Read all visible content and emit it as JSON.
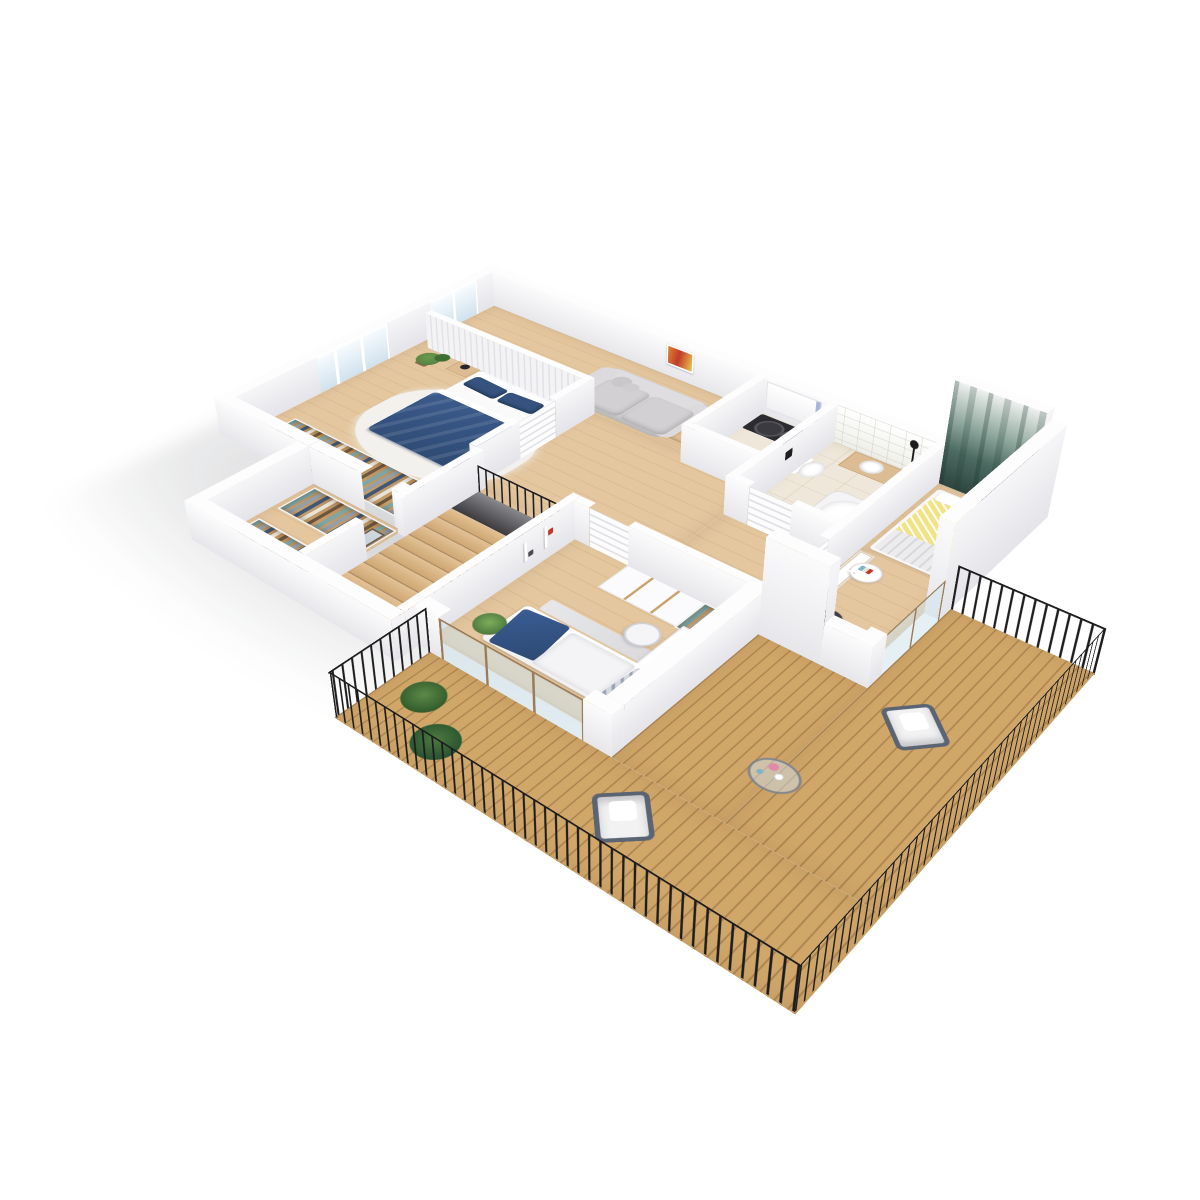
{
  "scene": {
    "type": "isometric 3D floor plan rendering",
    "description": "Photoreal axonometric cutaway of an apartment upper floor with balcony, white walls, oak floors, no text labels",
    "background": "#ffffff",
    "view": "isometric from above, rotated ~40 degrees"
  },
  "palette": {
    "wood": "#e4c79f",
    "deck": "#d0a669",
    "tile": "#efe8da",
    "wall_top": "#fdfdfe",
    "wall_face": "#ececf0",
    "navy": "#35537e",
    "navy_deep": "#2e4a74",
    "yellow": "#f1e385",
    "mural_deep": "#2c453f",
    "sofa": "#d7d5d7",
    "wood_furn": "#dcbc92",
    "railing": "#1d1d20",
    "glass": "#cfe0ec",
    "plant": "#4e7a3f",
    "closet_wood": "#c9a26e",
    "counter_black": "#2c2c30",
    "rug": "#f2f1ee",
    "chair_gray": "#8f9094",
    "painting_orange": "#e0832f",
    "painting_red": "#c23b2a",
    "painting_yellow": "#e8c94f",
    "accent_periwinkle": "#aab6d8"
  },
  "rooms": [
    {
      "name": "Living room",
      "floor": "oak plank",
      "furniture": [
        "light gray rounded sofa with bolster pillows",
        "abstract orange painting on wall",
        "wooden three-drawer dresser",
        "dark desk with gray office chair"
      ]
    },
    {
      "name": "Master bedroom",
      "floor": "oak plank",
      "furniture": [
        "double bed with white sheets and navy duvet",
        "two navy pillows",
        "two wooden nightstands with black lamps",
        "white shag rug",
        "potted plant",
        "built-in open wardrobe with clothes",
        "paneled headboard wall",
        "window"
      ]
    },
    {
      "name": "Laundry room",
      "floor": "stone tile",
      "furniture": [
        "black countertop",
        "washing machine",
        "dryer",
        "white wall cabinets with periwinkle accent"
      ]
    },
    {
      "name": "Bathroom",
      "floor": "cream tile",
      "furniture": [
        "corner bathtub",
        "wall-hung toilet",
        "wood vanity with white basin",
        "black shower column on tiled wall"
      ]
    },
    {
      "name": "Hallway",
      "floor": "oak plank",
      "furniture": [
        "white louvered doors",
        "wall thermostat"
      ]
    },
    {
      "name": "Dressing room",
      "floor": "oak plank",
      "furniture": [
        "two open wardrobe rows with hanging clothes",
        "framed standing mirror"
      ]
    },
    {
      "name": "Staircase",
      "floor": "oak treads",
      "furniture": [
        "nine wooden treads",
        "black metal railing",
        "stair void"
      ]
    },
    {
      "name": "Kids bedroom",
      "floor": "oak plank",
      "furniture": [
        "single bed with navy throw and chevron pillow",
        "white wardrobe with wood trim and open clothes section",
        "white desk with white office chair",
        "wall shelves with small decor",
        "yucca plant",
        "gray runner rug",
        "sliding glass door to balcony"
      ]
    },
    {
      "name": "Bedroom with forest mural",
      "floor": "oak plank",
      "furniture": [
        "dark green misty forest mural feature wall",
        "double bed with yellow chevron duvet and gray quilt",
        "round white side table with books",
        "white cabinet",
        "white desk with dark office chair",
        "sliding glass door to balcony"
      ]
    },
    {
      "name": "Balcony terrace",
      "floor": "warm wood decking",
      "furniture": [
        "black picket railing",
        "two white armchairs with dark metal frames",
        "round glass coffee table with pink flowers",
        "two potted palm plants"
      ]
    }
  ],
  "counts": {
    "windows": 2,
    "louvered_doors": 4,
    "sliding_glass_doors": 2,
    "stair_treads": 9,
    "balcony_armchairs": 2,
    "wardrobe_rows": 4
  }
}
